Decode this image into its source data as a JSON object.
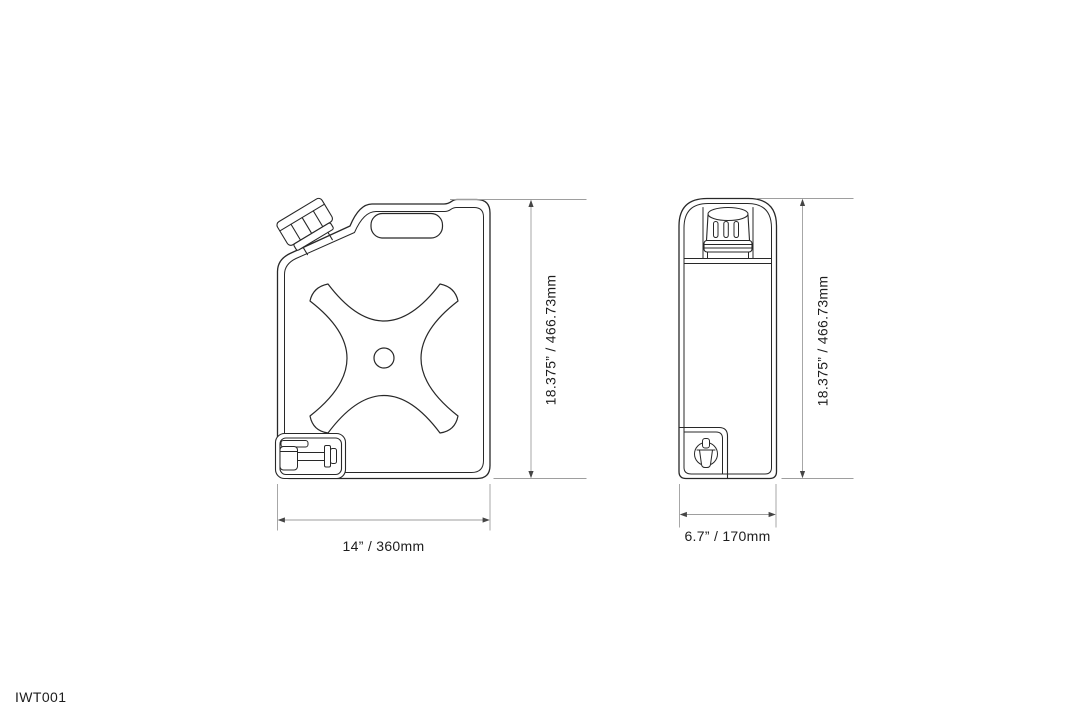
{
  "drawing": {
    "part_number": "IWT001",
    "views": {
      "front": {
        "title": "front view of jerry can water tank",
        "height_label": "18.375” / 466.73mm",
        "width_label": "14” / 360mm"
      },
      "side": {
        "title": "side view of jerry can water tank",
        "height_label": "18.375” / 466.73mm",
        "width_label": "6.7” / 170mm"
      }
    },
    "colors": {
      "background": "#ffffff",
      "outline": "#282828",
      "dimension_line": "#9e9e9e",
      "arrow": "#454545",
      "text": "#1d1d1d"
    }
  }
}
